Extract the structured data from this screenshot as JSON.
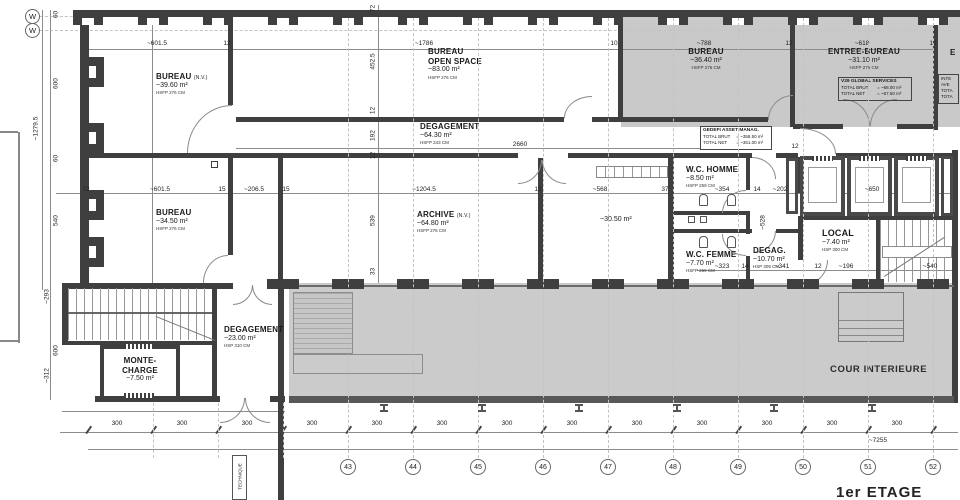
{
  "title": {
    "floor_label": "1er ETAGE"
  },
  "rooms": {
    "bureau_nw": {
      "name": "BUREAU",
      "tag": "(N.V.)",
      "area": "~39.60 m²",
      "ceiling": "HSFP 276 CM"
    },
    "open_space": {
      "name": "BUREAU",
      "name2": "OPEN SPACE",
      "area": "~83.00 m²",
      "ceiling": "HSFP 276 CM"
    },
    "bureau_ne": {
      "name": "BUREAU",
      "area": "~36.40 m²",
      "ceiling": "HSFP 276 CM"
    },
    "entree_bureau": {
      "name": "ENTREE-BUREAU",
      "area": "~31.10 m²",
      "ceiling": "HSFP 276 CM"
    },
    "edge_room": {
      "name": "E"
    },
    "degagement_mid": {
      "name": "DEGAGEMENT",
      "area": "~64.30 m²",
      "ceiling": "HSFP 243 CM"
    },
    "bureau_sw": {
      "name": "BUREAU",
      "area": "~34.50 m²",
      "ceiling": "HSFP 276 CM"
    },
    "archive": {
      "name": "ARCHIVE",
      "tag": "(N.V.)",
      "area": "~64.80 m²",
      "ceiling": "HSFP 276 CM"
    },
    "salle_3050": {
      "area": "~30.50 m²"
    },
    "wc_homme": {
      "name": "W.C. HOMME",
      "area": "~8.50 m²",
      "ceiling": "HSFP 259 CM"
    },
    "wc_femme": {
      "name": "W.C. FEMME",
      "area": "~7.70 m²",
      "ceiling": "HSFP 259 CM"
    },
    "degag": {
      "name": "DEGAG.",
      "area": "~10.70 m²",
      "ceiling": "HSP 309 CM"
    },
    "local": {
      "name": "LOCAL",
      "area": "~7.40 m²",
      "ceiling": "HSP 300 CM"
    },
    "monte_charge": {
      "name": "MONTE-",
      "name2": "CHARGE",
      "area": "~7.50 m²"
    },
    "degagement_sw": {
      "name": "DEGAGEMENT",
      "area": "~23.00 m²",
      "ceiling": "HSP 310 CM"
    },
    "cour": {
      "name": "COUR INTERIEURE"
    },
    "technique": {
      "name": "TECHNIQUE"
    }
  },
  "info_boxes": {
    "v29": {
      "title": "V29 GLOBAL SERVICES",
      "row1_label": "TOTAL BRUT",
      "row1_value": "= ~68.00 m²",
      "row2_label": "TOTAL NET",
      "row2_value": "= ~67.50 m²"
    },
    "gedefi": {
      "title": "GEDEFI ASSET MANAG.",
      "row1_label": "TOTAL BRUT",
      "row1_value": "= ~358.50 m²",
      "row2_label": "TOTAL NET",
      "row2_value": "= ~351.00 m²"
    },
    "edge": {
      "line1": "INTE",
      "line2": "AVE",
      "line3": "TOTA",
      "line4": "TOTA"
    }
  },
  "grid": {
    "bubbles": [
      "43",
      "44",
      "45",
      "46",
      "47",
      "48",
      "49",
      "50",
      "51",
      "52"
    ],
    "west": [
      "W",
      "W"
    ]
  },
  "dims": {
    "top_601": "~601.5",
    "top_12a": "12",
    "top_1786": "~1786",
    "top_10": "10",
    "top_788": "~788",
    "top_12b": "12",
    "top_618": "~618",
    "top_12c": "12",
    "mid_2660": "2660",
    "m_12": "12",
    "b2_72": "72",
    "b2_601": "~601.5",
    "b2_15a": "15",
    "b2_206": "~206.5",
    "b2_15b": "15",
    "b2_1204": "~1204.5",
    "b2_12": "12",
    "b2_568": "~568",
    "b2_37": "37",
    "b2_354": "~354",
    "b2_14": "14",
    "b2_202": "~202",
    "b2_650": "~650",
    "b3_323": "~323",
    "b3_14": "14",
    "b3_341": "~341",
    "b3_12": "12",
    "b3_196": "~196",
    "b3_540": "~540",
    "v_60a": "60",
    "v_600a": "600",
    "v_1279": "~1279.5",
    "v_60b": "60",
    "v_540": "540",
    "v_293": "~293",
    "v_600b": "600",
    "v_312": "~312",
    "c_72": "72",
    "c_452": "452.5",
    "c_12a": "12",
    "c_192": "192",
    "c_12b": "12",
    "c_539": "539",
    "c_33": "33",
    "r_528": "~528",
    "bot_300": "300",
    "bot_total": "~7255"
  },
  "colors": {
    "wall": "#3f3f3f",
    "room_gray": "#c9c9c9",
    "courtyard": "#cbcbcb"
  }
}
